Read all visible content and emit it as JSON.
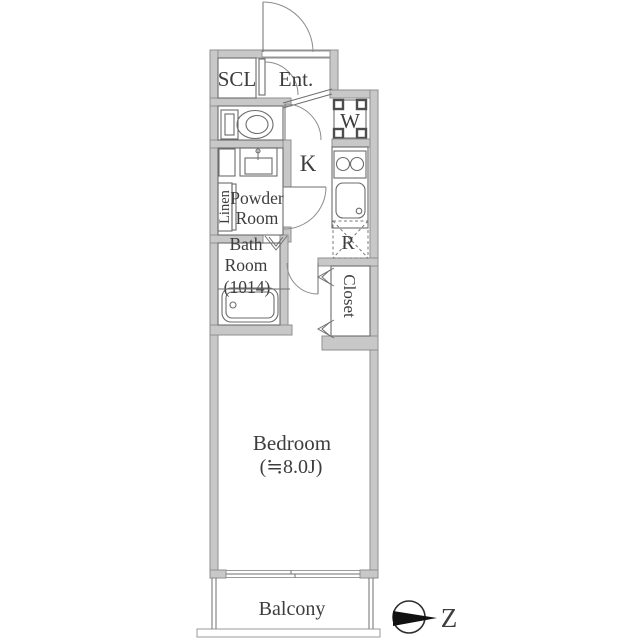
{
  "floorplan": {
    "labels": {
      "scl": "SCL",
      "entrance": "Ent.",
      "kitchen": "K",
      "washer": "W",
      "fridge": "R",
      "powder_line1": "Powder",
      "powder_line2": "Room",
      "linen": "Linen",
      "bath_line1": "Bath",
      "bath_line2": "Room",
      "bath_line3": "(1014)",
      "closet": "Closet",
      "bedroom_name": "Bedroom",
      "bedroom_size": "(≒8.0J)",
      "balcony": "Balcony",
      "compass": "Z"
    },
    "colors": {
      "wall_fill": "#c8c8c8",
      "wall_stroke": "#8f8f8f",
      "line": "#6b6b6b",
      "text": "#3d3d3d",
      "compass_fill": "#111111",
      "background": "#ffffff"
    }
  }
}
